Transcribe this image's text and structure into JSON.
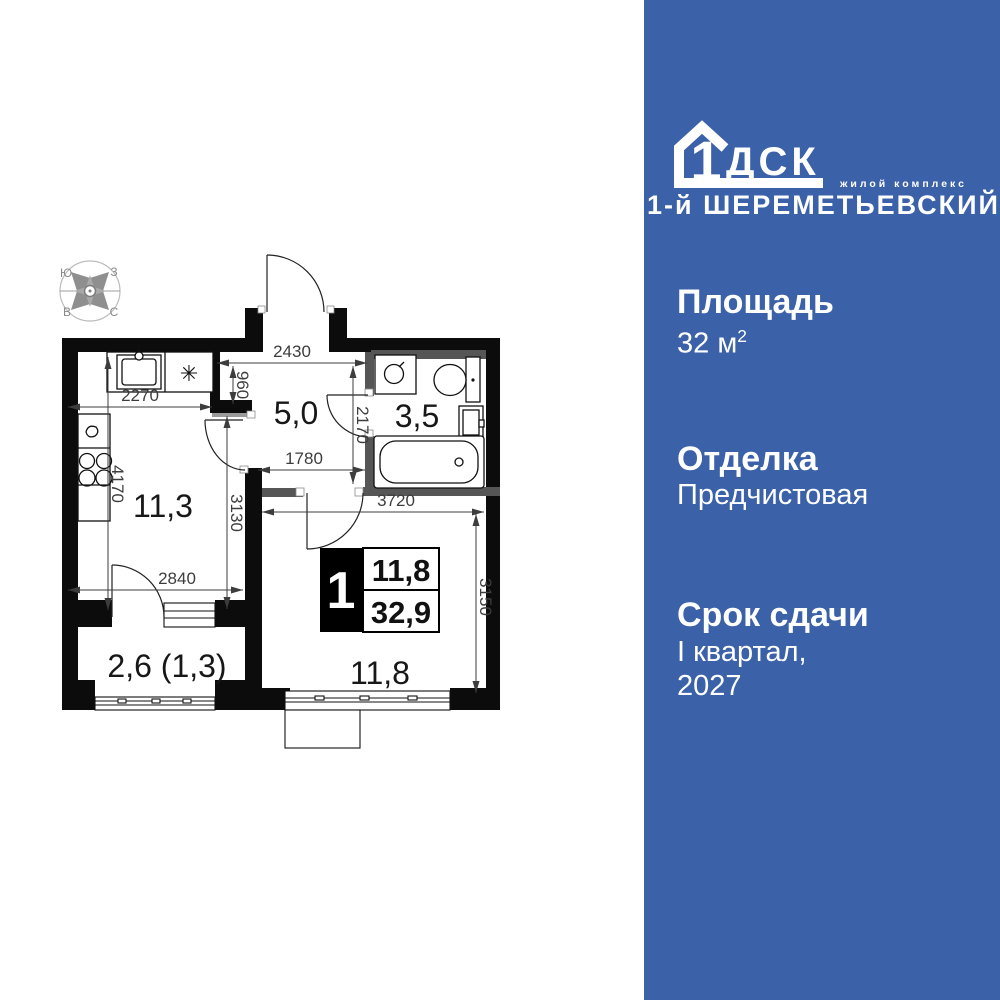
{
  "plan": {
    "compass": {
      "nw": "Ю",
      "ne": "З",
      "sw": "В",
      "se": "С"
    },
    "room_labels": {
      "kitchen": "11,3",
      "hallway": "5,0",
      "bathroom": "3,5",
      "living": "11,8",
      "balcony": "2,6 (1,3)"
    },
    "badge": {
      "rooms": "1",
      "room_area": "11,8",
      "total_area": "32,9"
    },
    "dims": {
      "hall_top_width": "2430",
      "kitchen_width": "2270",
      "niche_depth": "960",
      "bath_height": "2170",
      "hall_width": "1780",
      "kitchen_height": "4170",
      "hall_height": "3130",
      "kitchen_bottom_width": "2840",
      "living_width": "3720",
      "living_height": "3150"
    },
    "fixtures": {
      "fridge_symbol": "✳"
    }
  },
  "panel": {
    "colors": {
      "background": "#3B61A8",
      "text": "#FFFFFF"
    },
    "logo": {
      "one": "1",
      "letters": "ДСК",
      "tagline": "жилой комплекс",
      "complex": "1-й ШЕРЕМЕТЬЕВСКИЙ"
    },
    "sections": [
      {
        "label": "Площадь",
        "value": "32 м",
        "sup": "2"
      },
      {
        "label": "Отделка",
        "value": "Предчистовая"
      },
      {
        "label": "Срок сдачи",
        "value": "I квартал,",
        "value2": "2027"
      }
    ]
  }
}
